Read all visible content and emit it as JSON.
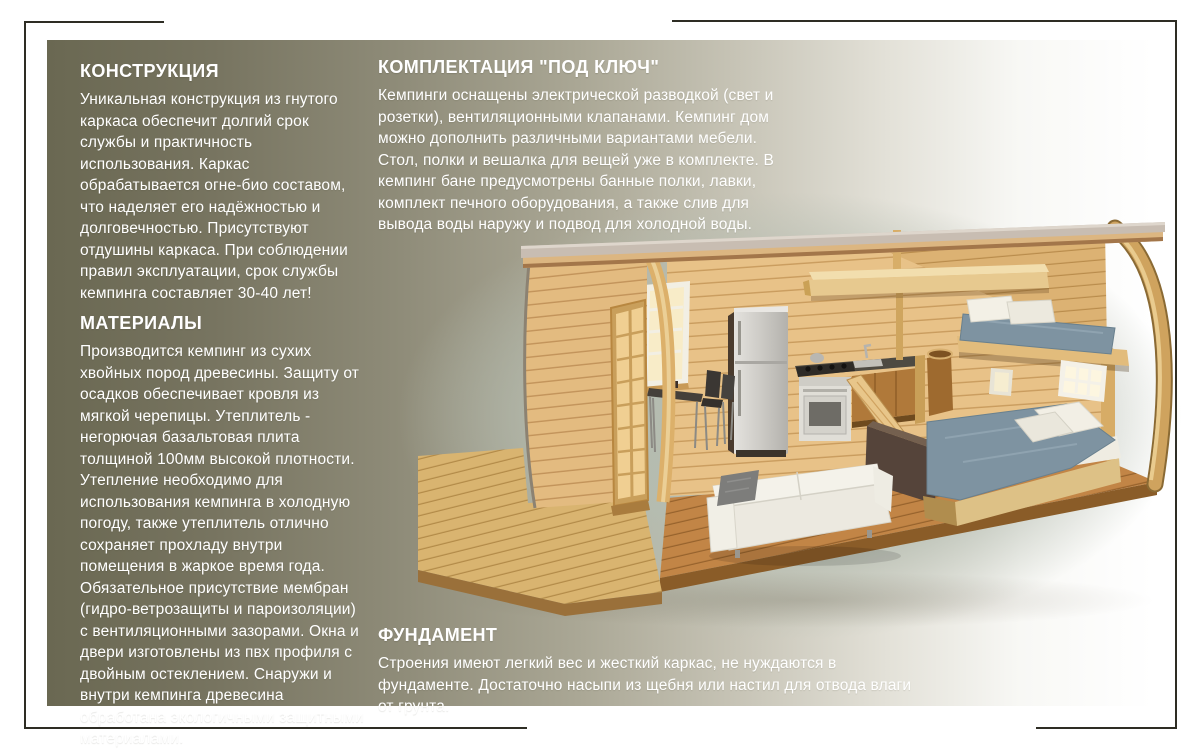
{
  "sections": {
    "construction": {
      "title": "КОНСТРУКЦИЯ",
      "body": "Уникальная конструкция из гнутого каркаса обеспечит долгий срок службы и практичность использования. Каркас обрабатывается огне-био составом, что наделяет его надёжностью и долговечностью. Присутствуют отдушины каркаса. При соблюдении правил эксплуатации, срок службы кемпинга составляет 30-40 лет!"
    },
    "materials": {
      "title": "МАТЕРИАЛЫ",
      "body": "Производится кемпинг из сухих хвойных пород древесины. Защиту от осадков обеспечивает кровля из мягкой черепицы.  Утеплитель - негорючая базальтовая плита толщиной 100мм высокой плотности. Утепление необходимо для использования кемпинга в холодную погоду, также утеплитель отлично сохраняет прохладу внутри помещения в жаркое время года. Обязательное присутствие мембран (гидро-ветрозащиты и пароизоляции) с вентиляционными зазорами. Окна и двери изготовлены из пвх профиля с двойным остеклением. Снаружи и внутри кемпинга древесина обработана экологичными  защитными материалами."
    },
    "package": {
      "title": "КОМПЛЕКТАЦИЯ \"ПОД КЛЮЧ\"",
      "body": "Кемпинги оснащены электрической разводкой (свет и розетки), вентиляционными клапанами. Кемпинг дом можно дополнить различными вариантами мебели. Стол, полки и вешалка для вещей уже в комплекте. В кемпинг бане предусмотрены банные полки, лавки, комплект печного оборудования, а также слив для вывода воды наружу и подвод для холодной воды."
    },
    "foundation": {
      "title": "ФУНДАМЕНТ",
      "body": "Строения имеют легкий вес и жесткий каркас, не нуждаются в фундаменте. Достаточно насыпи из щебня или настил для отвода влаги от грунта."
    }
  },
  "illustration": {
    "label": "camping-house-cutaway-render",
    "parts": [
      "curved-roof",
      "wood-deck",
      "glazed-door",
      "window",
      "fridge",
      "kitchen-stove",
      "dining-table",
      "sofa",
      "loft-shelf",
      "bunk-bed",
      "double-bed"
    ]
  },
  "colors": {
    "panel_gradient_start": "#6a6852",
    "panel_gradient_end": "#ffffff",
    "text": "#ffffff",
    "frame_line": "#2e2d24",
    "wood_wall": "#e8c288",
    "wood_floor": "#c28546",
    "wood_deck": "#d9b470",
    "mattress_blue": "#7e93a1",
    "sofa_white": "#ece9e0",
    "fridge_silver": "#cfcdc8",
    "roof_cap_gray": "#c8bdb2"
  }
}
